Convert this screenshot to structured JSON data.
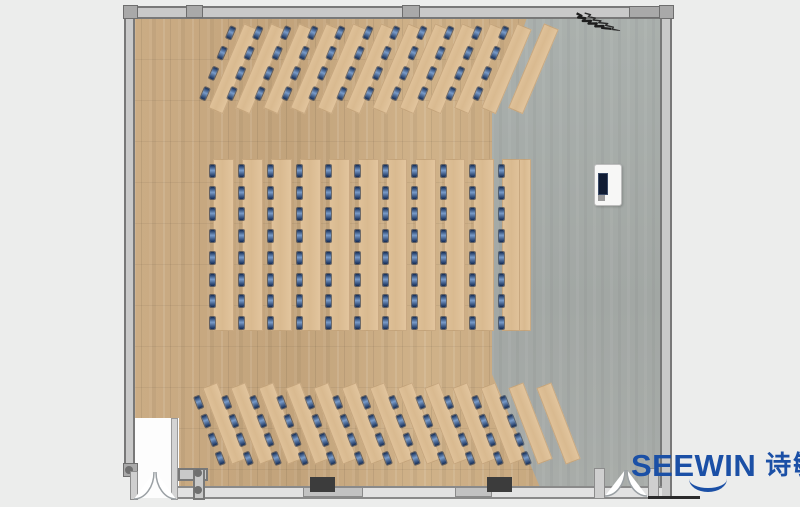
{
  "page": {
    "kind": "furniture-floor-plan-render",
    "background_color": "#ecedec"
  },
  "logo": {
    "brand": "SEEWIN",
    "brand_cn": "诗敏",
    "color": "#1b50a6"
  },
  "palette": {
    "wood_floor": "#c9aa82",
    "gray_floor": "#a7aba8",
    "desk_top": "#ddbf97",
    "chair_mark_navy": "#142c55",
    "chair_mark_light": "#7a9cc9",
    "wall_fill": "#c9c9c9",
    "wall_line": "#787878",
    "pillar": "#3c3c3c",
    "podium_body": "#f7f7f6",
    "podium_screen": "#101c33"
  },
  "floorplan": {
    "room": {
      "left": 124,
      "top": 6,
      "width": 548,
      "height": 492
    },
    "sections": [
      {
        "id": "top-rows",
        "type": "angled",
        "count": 12,
        "marked": 11,
        "origin": [
          212,
          20
        ],
        "pitch": 27.3,
        "rotation": 23,
        "slab_w": 16,
        "slab_h": 92,
        "unit_w": 30,
        "marks_per": 4,
        "mark_start": 8,
        "mark_pitch": 22
      },
      {
        "id": "middle-rows",
        "type": "straight",
        "count": 11,
        "marked": 11,
        "origin": [
          207,
          159
        ],
        "pitch": 28.9,
        "rotation": 0,
        "slab_w": 21,
        "slab_h": 172,
        "unit_w": 27,
        "marks_per": 8,
        "mark_start": 6,
        "mark_pitch": 21.7,
        "extra_slab": [
          519,
          159,
          12,
          172
        ]
      },
      {
        "id": "bottom-rows",
        "type": "angled",
        "count": 13,
        "marked": 12,
        "origin": [
          203,
          385
        ],
        "pitch": 27.8,
        "rotation": -21,
        "slab_w": 16,
        "slab_h": 82,
        "unit_w": 30,
        "marks_per": 4,
        "mark_start": 6,
        "mark_pitch": 20
      }
    ],
    "pillars": [
      {
        "left": 310,
        "top": 477,
        "width": 25,
        "height": 15
      },
      {
        "left": 487,
        "top": 477,
        "width": 25,
        "height": 15
      }
    ],
    "window_segments": [
      {
        "left": 303,
        "top": 487,
        "width": 58,
        "height": 8
      },
      {
        "left": 455,
        "top": 487,
        "width": 35,
        "height": 8
      }
    ],
    "mullions": [
      {
        "left": 123,
        "top": 5,
        "width": 13,
        "height": 12
      },
      {
        "left": 186,
        "top": 5,
        "width": 15,
        "height": 11
      },
      {
        "left": 402,
        "top": 5,
        "width": 16,
        "height": 11
      },
      {
        "left": 629,
        "top": 6,
        "width": 33,
        "height": 10
      },
      {
        "left": 659,
        "top": 5,
        "width": 13,
        "height": 12
      },
      {
        "left": 123,
        "top": 463,
        "width": 13,
        "height": 12
      }
    ]
  }
}
